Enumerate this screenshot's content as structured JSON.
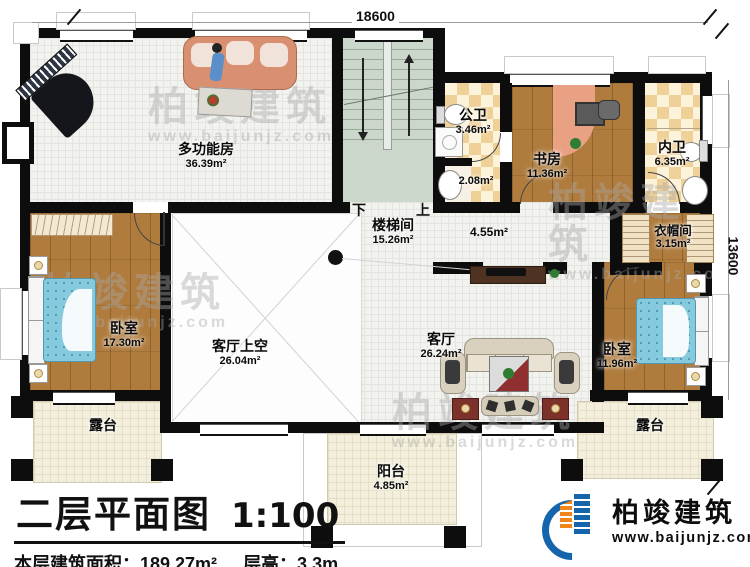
{
  "dimensions": {
    "top": "18600",
    "right": "13600"
  },
  "rooms": [
    {
      "name": "多功能房",
      "area": "36.39m²"
    },
    {
      "name": "公卫",
      "area": "3.46m²"
    },
    {
      "name": "",
      "area": "2.08m²"
    },
    {
      "name": "书房",
      "area": "11.36m²"
    },
    {
      "name": "内卫",
      "area": "6.35m²"
    },
    {
      "name": "楼梯间",
      "area": "15.26m²"
    },
    {
      "name": "",
      "area": "4.55m²"
    },
    {
      "name": "衣帽间",
      "area": "3.15m²"
    },
    {
      "name": "卧室",
      "area": "17.30m²"
    },
    {
      "name": "客厅上空",
      "area": "26.04m²"
    },
    {
      "name": "客厅",
      "area": "26.24m²"
    },
    {
      "name": "卧室",
      "area": "11.96m²"
    },
    {
      "name": "露台",
      "area": ""
    },
    {
      "name": "阳台",
      "area": "4.85m²"
    },
    {
      "name": "露台",
      "area": ""
    }
  ],
  "stairs": {
    "down": "下",
    "up": "上"
  },
  "title_block": {
    "title": "二层平面图",
    "scale": "1:100",
    "floor_area": "本层建筑面积：189.27m²",
    "floor_height": "层高：3.3m"
  },
  "logo": {
    "company": "柏竣建筑",
    "website": "www.baijunjz.com"
  },
  "watermark": {
    "text": "柏竣建筑",
    "url": "www.baijunjz.com"
  },
  "colors": {
    "wall": "#0d0d0d",
    "wood": "#b07c3e",
    "checker": "#efd096",
    "stair": "#ccd7cc",
    "tile": "#f3efdc",
    "logo_blue": "#1565ad",
    "logo_orange": "#f08519"
  }
}
